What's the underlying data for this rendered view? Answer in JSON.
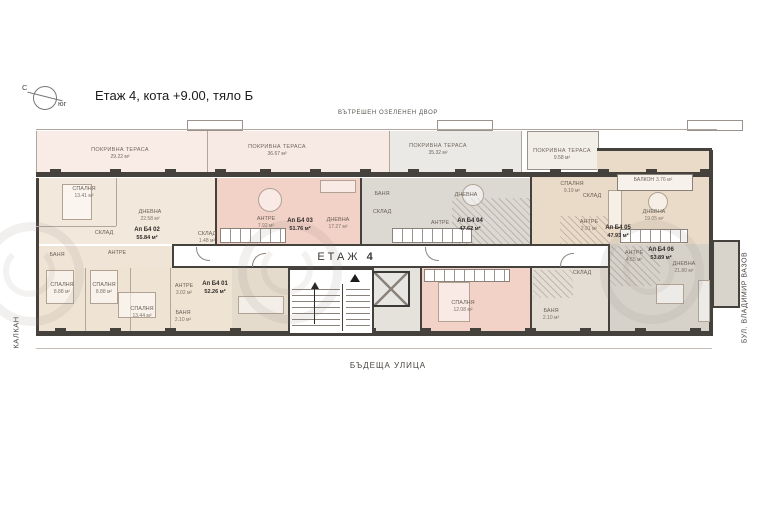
{
  "meta": {
    "title": "Етаж 4, кота +9.00, тяло Б"
  },
  "compass": {
    "north": "С",
    "south": "юг"
  },
  "surroundings": {
    "top": "ВЪТРЕШЕН ОЗЕЛЕНЕН ДВОР",
    "left": "КАЛКАН",
    "right": "БУЛ. ВЛАДИМИР ВАЗОВ",
    "bottom": "БЪДЕЩА УЛИЦА"
  },
  "floor": {
    "word": "ЕТАЖ",
    "number": "4"
  },
  "terraces": [
    {
      "name": "ПОКРИВНА ТЕРАСА",
      "area": "29.22 м²"
    },
    {
      "name": "ПОКРИВНА ТЕРАСА",
      "area": "36.67 м²"
    },
    {
      "name": "ПОКРИВНА ТЕРАСА",
      "area": "35.32 м²"
    },
    {
      "name": "ПОКРИВНА ТЕРАСА",
      "area": "9.58 м²"
    }
  ],
  "apartments": [
    {
      "id": "Ап Б4 01",
      "area": "52.26 м²",
      "rooms": [
        {
          "name": "СПАЛНЯ",
          "area": "8.88 м²"
        },
        {
          "name": "СПАЛНЯ",
          "area": "8.88 м²"
        },
        {
          "name": "СПАЛНЯ",
          "area": "13.44 м²"
        },
        {
          "name": "АНТРЕ",
          "area": "3.02 м²"
        },
        {
          "name": "БАНЯ",
          "area": "2.10 м²"
        }
      ]
    },
    {
      "id": "Ап Б4 02",
      "area": "55.84 м²",
      "rooms": [
        {
          "name": "СПАЛНЯ",
          "area": "13.41 м²"
        },
        {
          "name": "ДНЕВНА",
          "area": "22.58 м²"
        },
        {
          "name": "АНТРЕ",
          "area": ""
        },
        {
          "name": "СКЛАД",
          "area": ""
        },
        {
          "name": "БАНЯ",
          "area": ""
        }
      ]
    },
    {
      "id": "Ап Б4 03",
      "area": "51.76 м²",
      "rooms": [
        {
          "name": "ДНЕВНА",
          "area": "17.27 м²"
        },
        {
          "name": "АНТРЕ",
          "area": "7.92 м²"
        },
        {
          "name": "СКЛАД",
          "area": "1.48 м²"
        }
      ]
    },
    {
      "id": "Ап Б4 04",
      "area": "47.62 м²",
      "rooms": [
        {
          "name": "ДНЕВНА",
          "area": ""
        },
        {
          "name": "АНТРЕ",
          "area": ""
        },
        {
          "name": "БАНЯ",
          "area": ""
        },
        {
          "name": "СКЛАД",
          "area": ""
        }
      ]
    },
    {
      "id": "Ап Б4 05",
      "area": "47.93 м²",
      "rooms": [
        {
          "name": "СПАЛНЯ",
          "area": "9.19 м²"
        },
        {
          "name": "ДНЕВНА",
          "area": "19.05 м²"
        },
        {
          "name": "АНТРЕ",
          "area": "2.91 м²"
        },
        {
          "name": "СКЛАД",
          "area": ""
        },
        {
          "name": "БАЛКОН",
          "area": "3.76 м²"
        }
      ]
    },
    {
      "id": "Ап Б4 06",
      "area": "53.89 м²",
      "rooms": [
        {
          "name": "СПАЛНЯ",
          "area": "12.08 м²"
        },
        {
          "name": "ДНЕВНА",
          "area": "21.80 м²"
        },
        {
          "name": "АНТРЕ",
          "area": "4.55 м²"
        },
        {
          "name": "БАНЯ",
          "area": "2.10 м²"
        },
        {
          "name": "СКЛАД",
          "area": ""
        }
      ]
    }
  ],
  "colors": {
    "wall": "#45413d",
    "terrace_pink": "#f9ece7",
    "terrace_grey": "#ebe9e5",
    "unit_cream": "#f3e8dc",
    "unit_pink": "#f2d1c6",
    "unit_grey": "#dcd8d2",
    "unit_tan": "#eadbc8"
  }
}
